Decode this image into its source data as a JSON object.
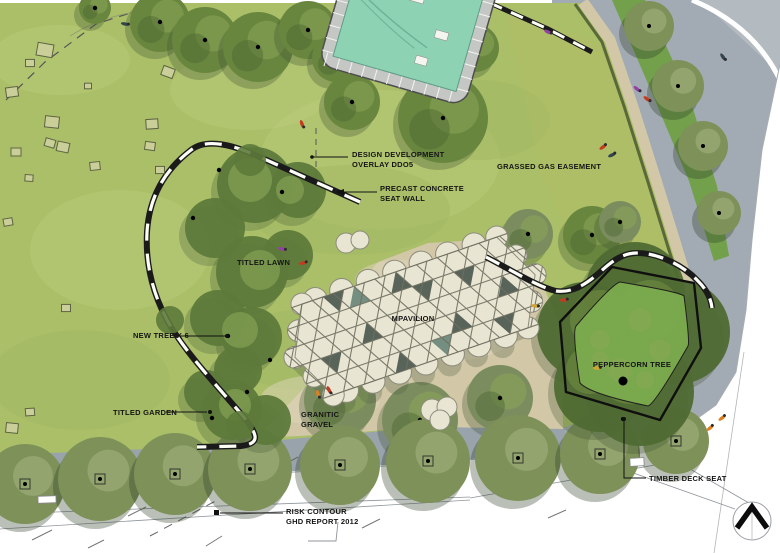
{
  "labels": {
    "design_overlay": "DESIGN DEVELOPMENT\nOVERLAY DDO5",
    "seat_wall": "PRECAST CONCRETE\nSEAT WALL",
    "gas_easement": "GRASSED GAS EASEMENT",
    "titled_lawn": "TITLED LAWN",
    "new_tree": "NEW TREE X 6",
    "mpavilion": "MPAVILION",
    "titled_garden": "TITLED GARDEN",
    "granitic_gravel": "GRANITIC\nGRAVEL",
    "peppercorn_tree": "PEPPERCORN TREE",
    "timber_deck_seat": "TIMBER DECK SEAT",
    "risk_contour": "RISK CONTOUR\nGHD REPORT 2012"
  },
  "icons": {
    "north_arrow": "north-arrow"
  },
  "colors": {
    "paper": "#ffffff",
    "lawn": "#aabf68",
    "lawnLight": "#c3d086",
    "lawnShade": "#9cb05c",
    "easementTint": "#c7bd62",
    "canopy": "#69863f",
    "canopyDark": "#4f6a33",
    "canopyLight": "#8ba857",
    "streetCanopy": "#7d9159",
    "bedGreen": "#5d7a3b",
    "shadow": "#3c4f2e",
    "road": "#98a3ac",
    "plaza": "#a2abb3",
    "plazaLight": "#b3bac0",
    "median": "#72a04b",
    "gravel": "#d2c8a7",
    "gravelLight": "#ded5bb",
    "poolWater": "#8ed2b4",
    "poolDeck": "#c5c7c5",
    "pavCanopy": "#e9e5d3",
    "pavLine": "#6f6f60",
    "pavDark": "#3e4d44",
    "pavTeal": "#5f7f72",
    "wallInk": "#1a1a1a",
    "ink": "#151515",
    "lineGray": "#8f959a",
    "peppercorn": "#7cab4e",
    "square": "#ccd09c",
    "peopleRed": "#c43b22",
    "peopleOrange": "#df7f1e",
    "peoplePurple": "#9540a5",
    "peopleDark": "#33434d",
    "peopleYellow": "#d2a52e"
  }
}
